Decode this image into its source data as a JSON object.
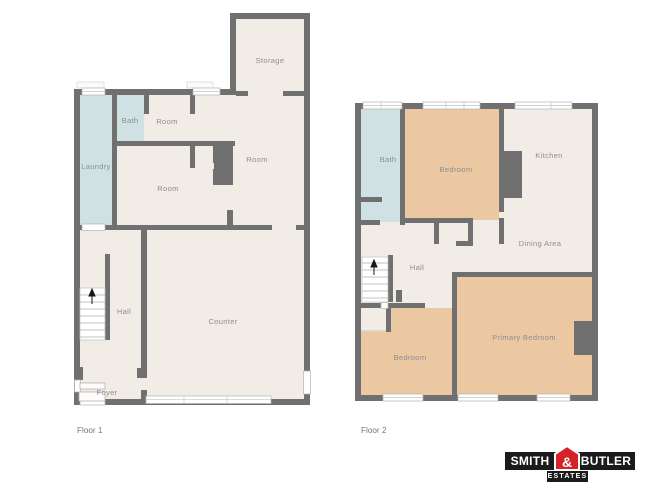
{
  "colors": {
    "wall": "#707070",
    "floor": "#f2ece6",
    "wet_room": "#cfe1e3",
    "bedroom": "#ebc7a2",
    "room_label": "#8f8f8f",
    "floor_label": "#6e7a84",
    "logo_black": "#1b1b1b",
    "logo_red": "#d4212a"
  },
  "floor1": {
    "label": "Floor 1",
    "rooms": {
      "storage": "Storage",
      "bath": "Bath",
      "room_top": "Room",
      "laundry": "Laundry",
      "room_middle": "Room",
      "room_right": "Room",
      "hall": "Hall",
      "counter": "Counter",
      "foyer": "Foyer"
    }
  },
  "floor2": {
    "label": "Floor 2",
    "rooms": {
      "bath": "Bath",
      "bedroom": "Bedroom",
      "kitchen": "Kitchen",
      "dining": "Dining Area",
      "hall": "Hall",
      "bedroom2": "Bedroom",
      "primary": "Primary Bedroom"
    }
  },
  "logo": {
    "word_left": "SMITH",
    "ampersand": "&",
    "word_right": "BUTLER",
    "tagline": "ESTATES"
  }
}
